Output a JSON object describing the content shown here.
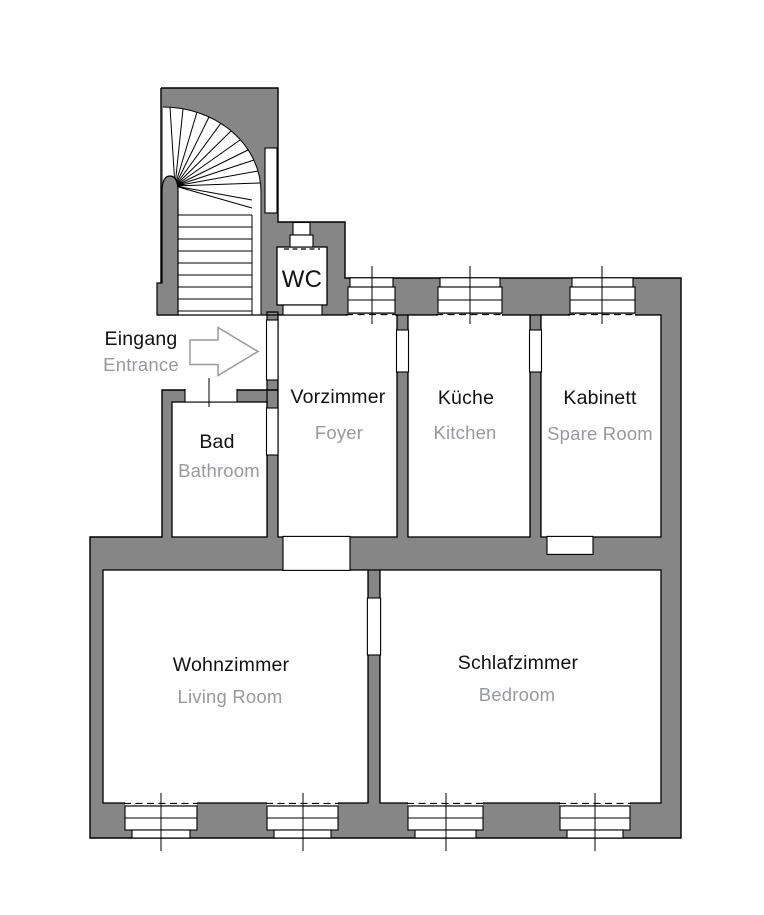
{
  "floorplan": {
    "entrance": {
      "primary": "Eingang",
      "secondary": "Entrance",
      "arrow_direction": "right"
    },
    "rooms": [
      {
        "key": "wc",
        "primary": "WC",
        "secondary": ""
      },
      {
        "key": "vorzimmer",
        "primary": "Vorzimmer",
        "secondary": "Foyer"
      },
      {
        "key": "kueche",
        "primary": "Küche",
        "secondary": "Kitchen"
      },
      {
        "key": "kabinett",
        "primary": "Kabinett",
        "secondary": "Spare Room"
      },
      {
        "key": "bad",
        "primary": "Bad",
        "secondary": "Bathroom"
      },
      {
        "key": "wohnzimmer",
        "primary": "Wohnzimmer",
        "secondary": "Living Room"
      },
      {
        "key": "schlafzimmer",
        "primary": "Schlafzimmer",
        "secondary": "Bedroom"
      }
    ],
    "colors": {
      "wall": "#868686",
      "outline": "#000000",
      "text_primary": "#111111",
      "text_secondary": "#97999d",
      "arrow_outline": "#9a9a9a",
      "background": "#ffffff"
    }
  }
}
